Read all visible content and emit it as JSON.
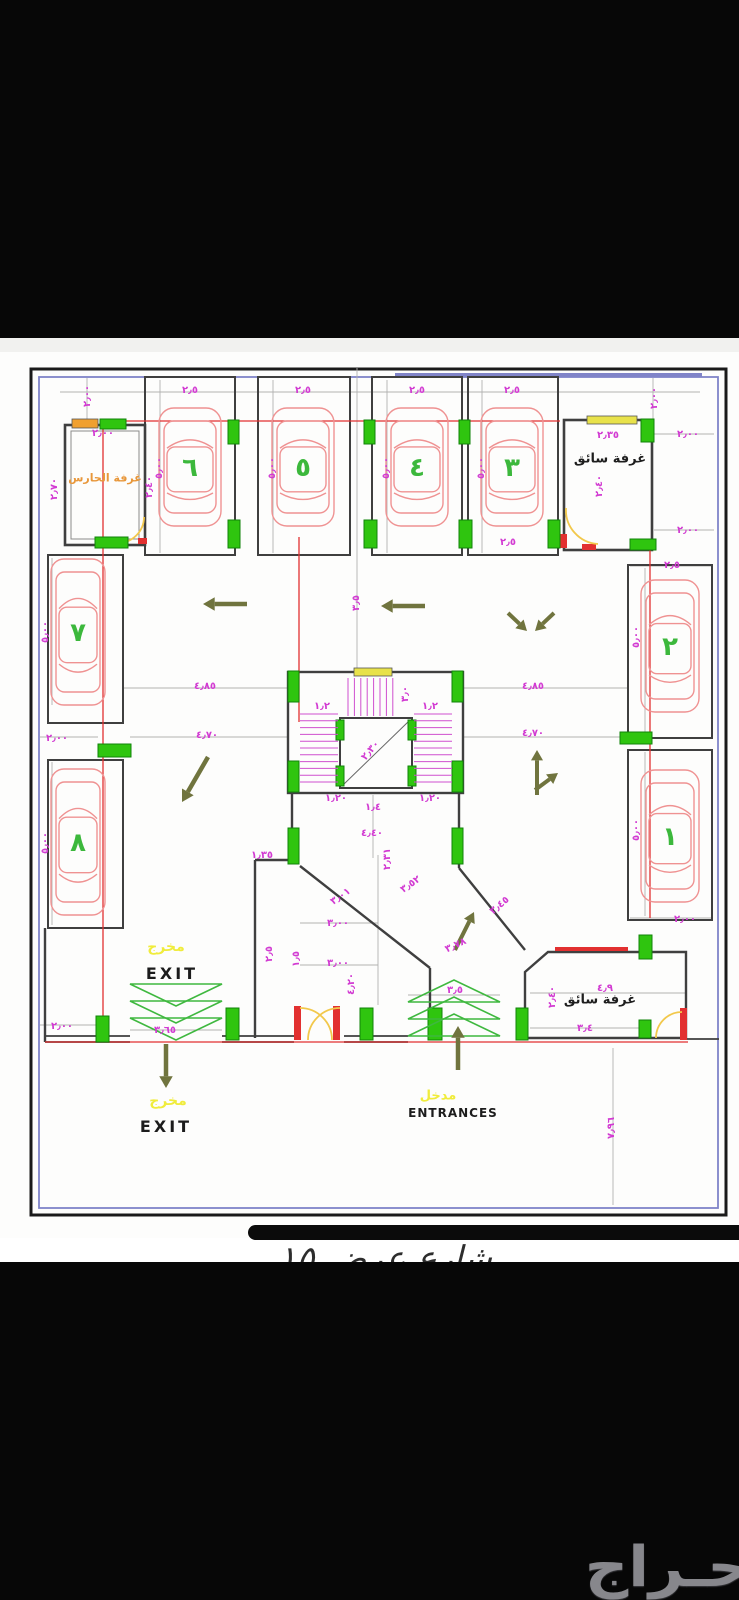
{
  "watermark": {
    "logo_text": "حـراج"
  },
  "street_note": "شارع عرض ١٥",
  "colors": {
    "dim_magenta": "#d23bd2",
    "column_green": "#2fc50f",
    "car_red": "#ef9292",
    "car_number_green": "#3cb83c",
    "arrow_olive": "#70743e",
    "ramp_green": "#3fb83f",
    "door_yellow": "#f2c84b",
    "accent_red": "#e23030",
    "border_purple": "#8084c8"
  },
  "plan": {
    "room_labels": [
      {
        "x": 105,
        "y": 478,
        "t": "غرفة الحارس",
        "c": "#e8973a",
        "fs": 11,
        "b": 1,
        "name": "guard-room-label"
      },
      {
        "x": 610,
        "y": 459,
        "t": "غرفة سائق",
        "c": "#1e1e1e",
        "fs": 13,
        "b": 1,
        "name": "driver-room-top-label"
      },
      {
        "x": 600,
        "y": 1000,
        "t": "غرفة سائق",
        "c": "#1e1e1e",
        "fs": 13,
        "b": 1,
        "name": "driver-room-bottom-label"
      },
      {
        "x": 166,
        "y": 947,
        "t": "مخرج",
        "c": "#f0ec3c",
        "fs": 14,
        "b": 1,
        "name": "exit-arabic-label-inner"
      },
      {
        "x": 172,
        "y": 974,
        "t": "EXIT",
        "c": "#1c1c1c",
        "fs": 16,
        "b": 1,
        "ls": 3,
        "name": "exit-label-inner"
      },
      {
        "x": 168,
        "y": 1101,
        "t": "مخرج",
        "c": "#f0ec3c",
        "fs": 14,
        "b": 1,
        "name": "exit-arabic-label-outer"
      },
      {
        "x": 166,
        "y": 1127,
        "t": "EXIT",
        "c": "#1c1c1c",
        "fs": 16,
        "b": 1,
        "ls": 3,
        "name": "exit-label-outer"
      },
      {
        "x": 438,
        "y": 1096,
        "t": "مدخل",
        "c": "#f0ec3c",
        "fs": 13,
        "b": 1,
        "name": "entrance-arabic-label"
      },
      {
        "x": 453,
        "y": 1113,
        "t": "ENTRANCES",
        "c": "#1c1c1c",
        "fs": 12,
        "b": 1,
        "ls": 1,
        "name": "entrances-label"
      }
    ],
    "dims": [
      [
        88,
        396,
        -90,
        "٢٫٠٠"
      ],
      [
        655,
        398,
        -90,
        "٢٫٠٠"
      ],
      [
        190,
        391,
        0,
        "٢٫٥"
      ],
      [
        303,
        391,
        0,
        "٢٫٥"
      ],
      [
        417,
        391,
        0,
        "٢٫٥"
      ],
      [
        512,
        391,
        0,
        "٢٫٥"
      ],
      [
        103,
        434,
        0,
        "٢٫٠٠"
      ],
      [
        150,
        487,
        -90,
        "٢٫٤٠"
      ],
      [
        55,
        489,
        -90,
        "٢٫٧٠"
      ],
      [
        160,
        468,
        -90,
        "٥٫٠٠"
      ],
      [
        273,
        468,
        -90,
        "٥٫٠٠"
      ],
      [
        387,
        468,
        -90,
        "٥٫٠٠"
      ],
      [
        482,
        468,
        -90,
        "٥٫٠٠"
      ],
      [
        608,
        436,
        0,
        "٢٫٣٥"
      ],
      [
        600,
        486,
        -90,
        "٢٫٤٠"
      ],
      [
        688,
        435,
        0,
        "٢٫٠٠"
      ],
      [
        688,
        531,
        0,
        "٢٫٠٠"
      ],
      [
        508,
        543,
        0,
        "٢٫٥"
      ],
      [
        672,
        566,
        0,
        "٢٫٥"
      ],
      [
        637,
        637,
        -90,
        "٥٫٠٠"
      ],
      [
        637,
        830,
        -90,
        "٥٫٠٠"
      ],
      [
        685,
        920,
        0,
        "٢٫٠٠"
      ],
      [
        46,
        632,
        -90,
        "٥٫٠٠"
      ],
      [
        46,
        843,
        -90,
        "٥٫٠٠"
      ],
      [
        57,
        739,
        0,
        "٢٫٠٠"
      ],
      [
        205,
        687,
        0,
        "٤٫٨٥"
      ],
      [
        533,
        687,
        0,
        "٤٫٨٥"
      ],
      [
        207,
        736,
        0,
        "٤٫٧٠"
      ],
      [
        533,
        734,
        0,
        "٤٫٧٠"
      ],
      [
        357,
        603,
        -90,
        "٣٫٥"
      ],
      [
        322,
        707,
        0,
        "١٫٢"
      ],
      [
        430,
        707,
        0,
        "١٫٢"
      ],
      [
        406,
        694,
        -90,
        "٣٫٠"
      ],
      [
        371,
        751,
        -50,
        "٢٫٣٠"
      ],
      [
        336,
        799,
        0,
        "١٫٢٠"
      ],
      [
        430,
        799,
        0,
        "١٫٢٠"
      ],
      [
        373,
        808,
        0,
        "١٫٤"
      ],
      [
        262,
        856,
        0,
        "١٫٣٥"
      ],
      [
        372,
        834,
        0,
        "٤٫٤٠"
      ],
      [
        388,
        859,
        -90,
        "٢٫٣١"
      ],
      [
        341,
        897,
        -35,
        "٣٫٠١"
      ],
      [
        411,
        885,
        -35,
        "٣٫٥٢"
      ],
      [
        500,
        906,
        -40,
        "٣٫٤٥"
      ],
      [
        338,
        924,
        0,
        "٣٫٠٠"
      ],
      [
        338,
        964,
        0,
        "٣٫٠٠"
      ],
      [
        270,
        954,
        -90,
        "٢٫٥"
      ],
      [
        297,
        959,
        -90,
        "١٫٥"
      ],
      [
        352,
        984,
        -90,
        "٤٫٢٠"
      ],
      [
        456,
        946,
        -25,
        "٣٫٧٨"
      ],
      [
        455,
        991,
        0,
        "٣٫٥"
      ],
      [
        165,
        1031,
        0,
        "٣٫٦٥"
      ],
      [
        62,
        1027,
        0,
        "٢٫٠٠"
      ],
      [
        605,
        989,
        0,
        "٤٫٩"
      ],
      [
        553,
        997,
        -90,
        "٢٫٤٠"
      ],
      [
        585,
        1029,
        0,
        "٣٫٤"
      ],
      [
        612,
        1128,
        -90,
        "٧٫٩٦"
      ]
    ],
    "cars": [
      {
        "n": "٦",
        "x": 190,
        "y": 467,
        "w": 62,
        "h": 118
      },
      {
        "n": "٥",
        "x": 303,
        "y": 467,
        "w": 62,
        "h": 118
      },
      {
        "n": "٤",
        "x": 417,
        "y": 467,
        "w": 62,
        "h": 118
      },
      {
        "n": "٣",
        "x": 512,
        "y": 467,
        "w": 62,
        "h": 118
      },
      {
        "n": "٧",
        "x": 78,
        "y": 632,
        "w": 54,
        "h": 146
      },
      {
        "n": "٨",
        "x": 78,
        "y": 842,
        "w": 54,
        "h": 146
      },
      {
        "n": "٢",
        "x": 670,
        "y": 646,
        "w": 58,
        "h": 132
      },
      {
        "n": "١",
        "x": 670,
        "y": 836,
        "w": 58,
        "h": 132
      }
    ]
  }
}
